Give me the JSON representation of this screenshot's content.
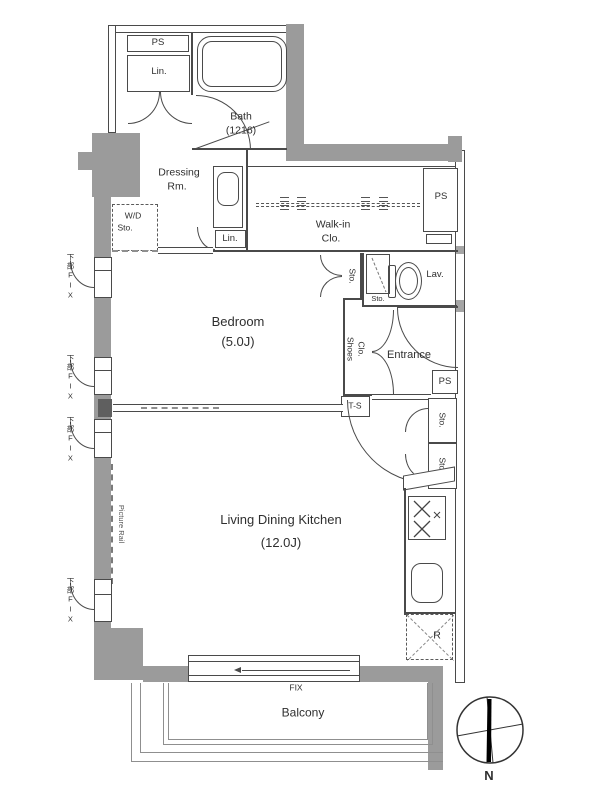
{
  "colors": {
    "wall": "#9b9b9b",
    "line": "#4a4a4a",
    "text": "#2f2f2f"
  },
  "rooms": {
    "bath": {
      "name": "Bath",
      "size": "(1216)"
    },
    "dressing_room": {
      "line1": "Dressing",
      "line2": "Rm."
    },
    "walk_in_closet": {
      "line1": "Walk-in",
      "line2": "Clo."
    },
    "bedroom": {
      "name": "Bedroom",
      "size": "(5.0J)"
    },
    "living_dining_kitchen": {
      "name": "Living Dining Kitchen",
      "size": "(12.0J)"
    },
    "entrance": {
      "name": "Entrance"
    },
    "lavatory": {
      "name": "Lav."
    },
    "balcony": {
      "name": "Balcony"
    }
  },
  "labels": {
    "pipe_space": "PS",
    "linen": "Lin.",
    "washer_dryer": "W/D",
    "storage": "Sto.",
    "shoes_line1": "Shoes",
    "shoes_line2": "Clo.",
    "trunk_space": "T-S",
    "refrigerator": "R",
    "fix_window": "FIX",
    "lower_fix_window": "下部FIX",
    "picture_rail": "Picture Rail",
    "north": "N"
  }
}
